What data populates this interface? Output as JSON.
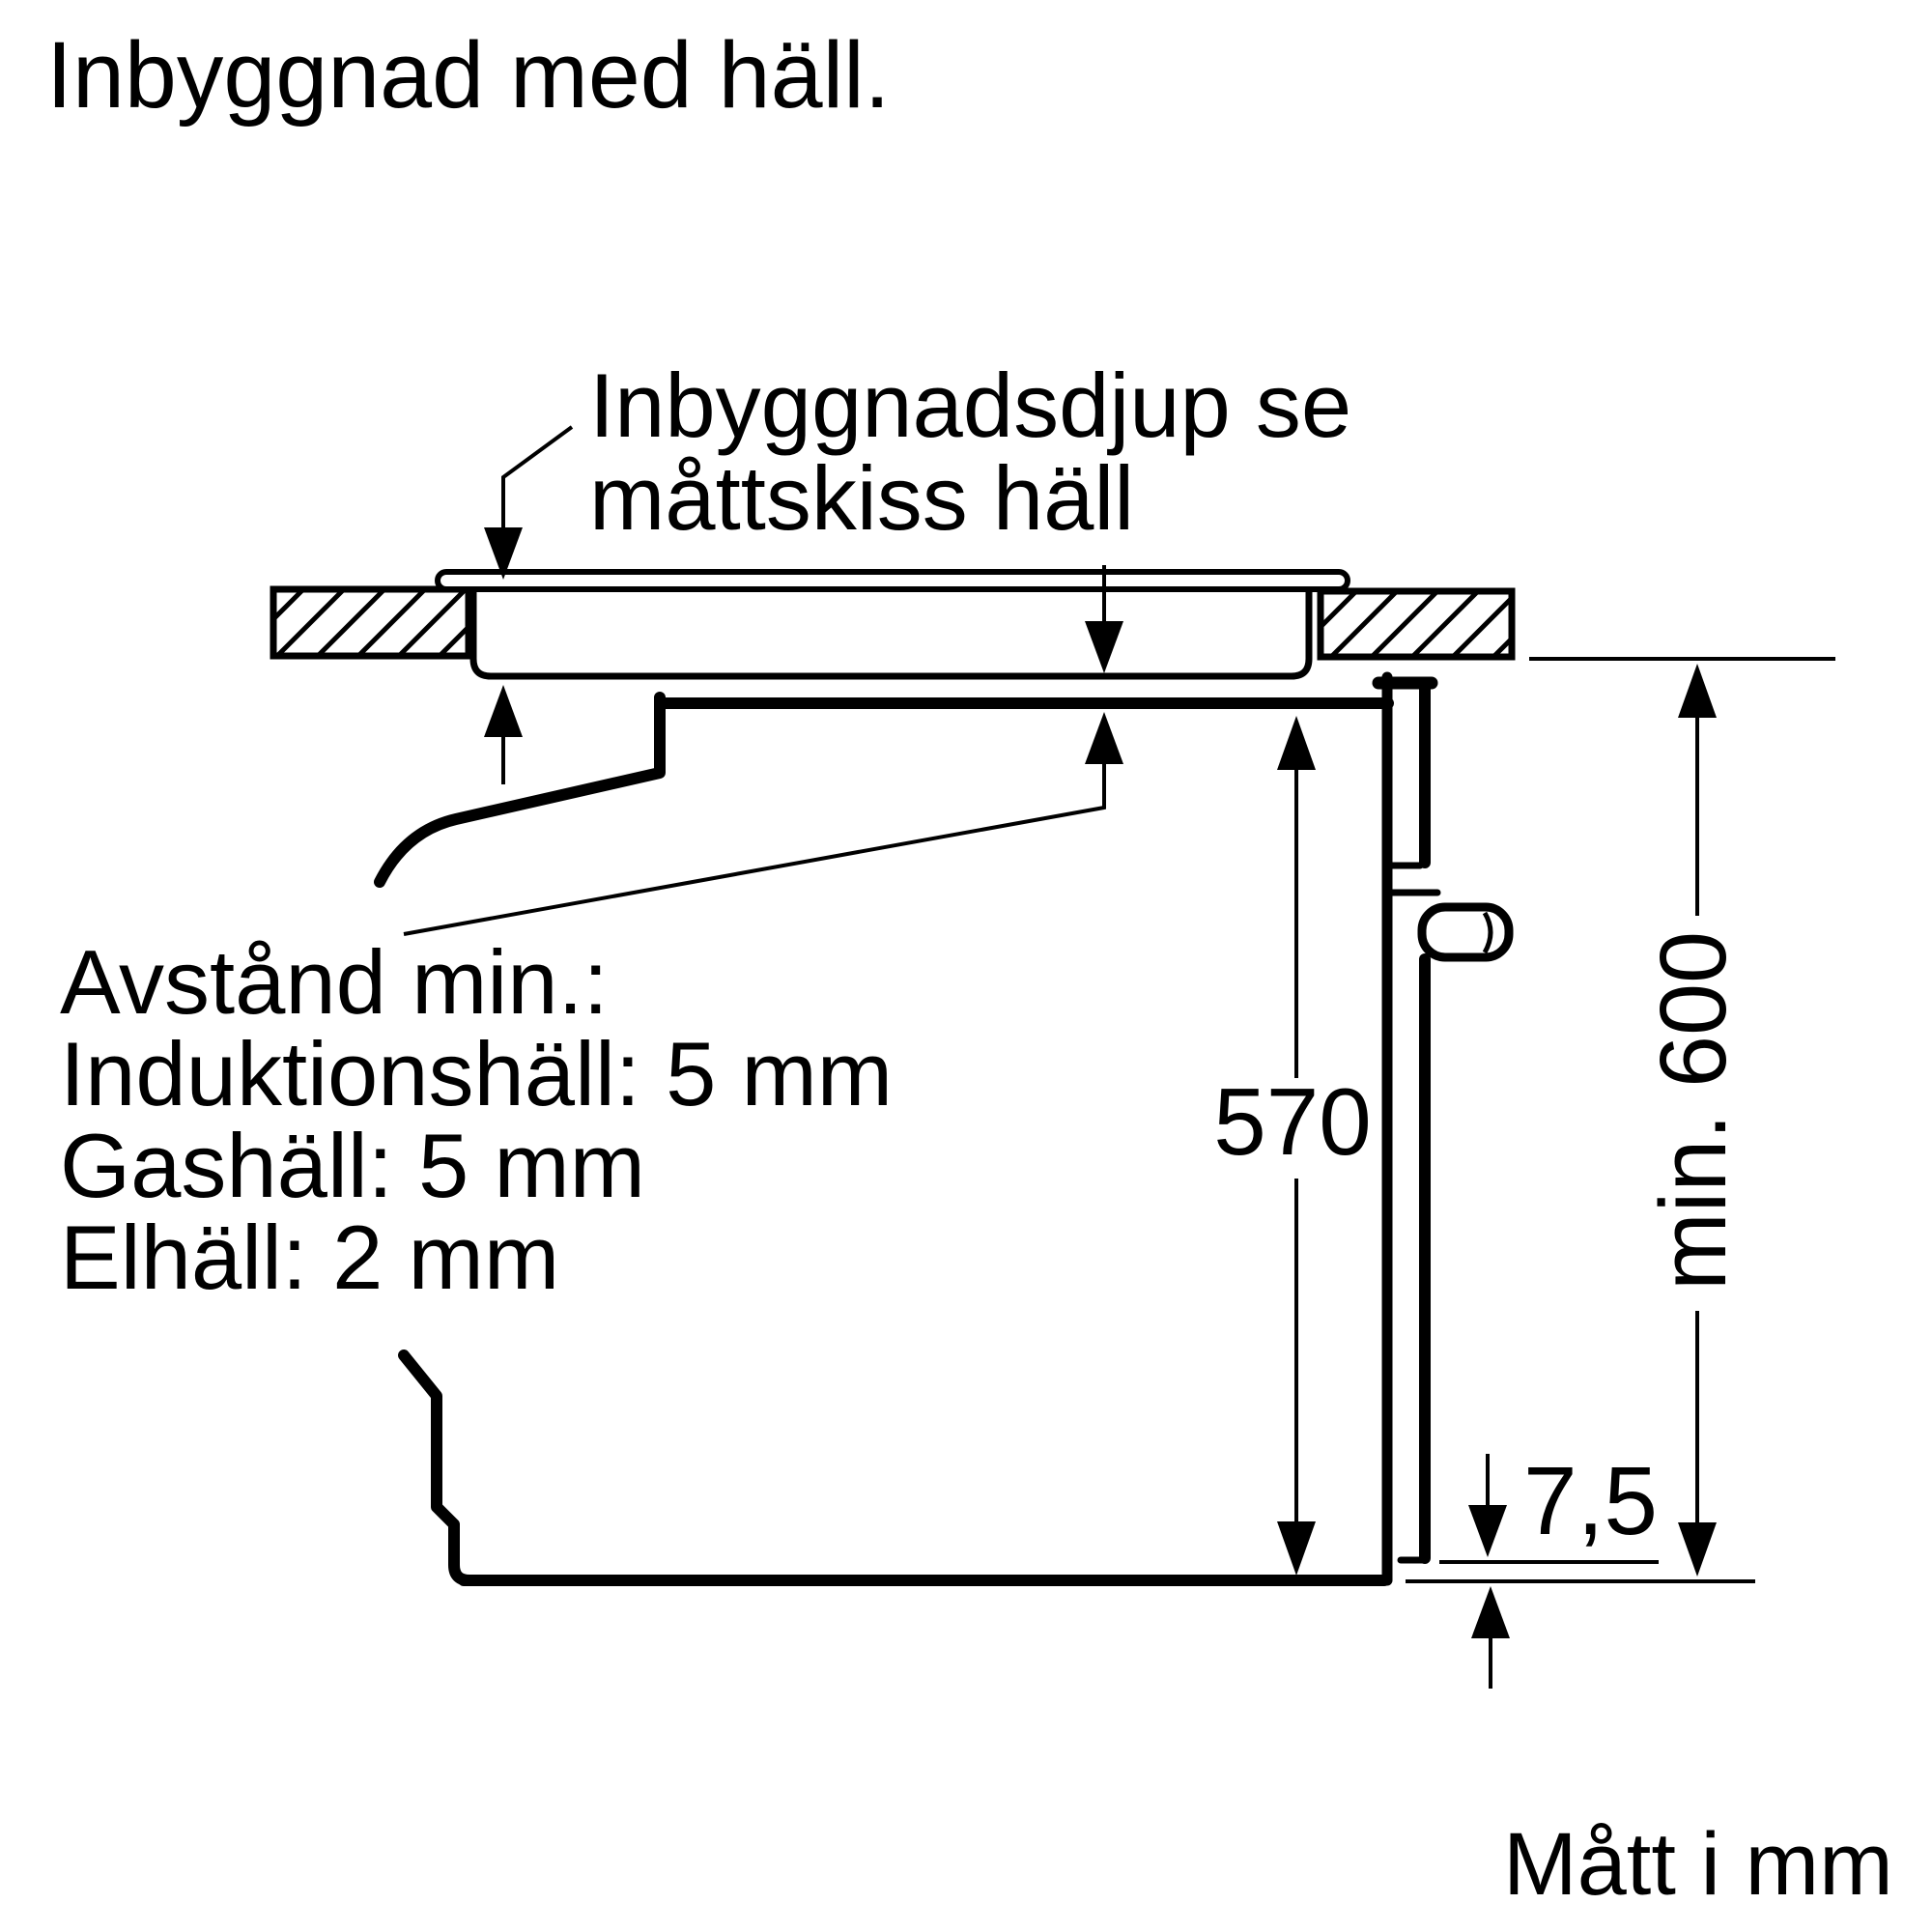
{
  "title": "Inbyggnad med häll.",
  "callout": {
    "lines": [
      "Inbyggnadsdjup se",
      "måttskiss häll"
    ]
  },
  "min_distance_note": {
    "lines": [
      "Avstånd min.:",
      "Induktionshäll: 5 mm",
      "Gashäll: 5 mm",
      "Elhäll: 2 mm"
    ]
  },
  "dimensions": {
    "oven_niche_depth": "570",
    "niche_height": "min. 600",
    "bottom_gap": "7,5"
  },
  "units_note": "Mått i mm",
  "colors": {
    "line": "#000000",
    "background": "#ffffff"
  }
}
